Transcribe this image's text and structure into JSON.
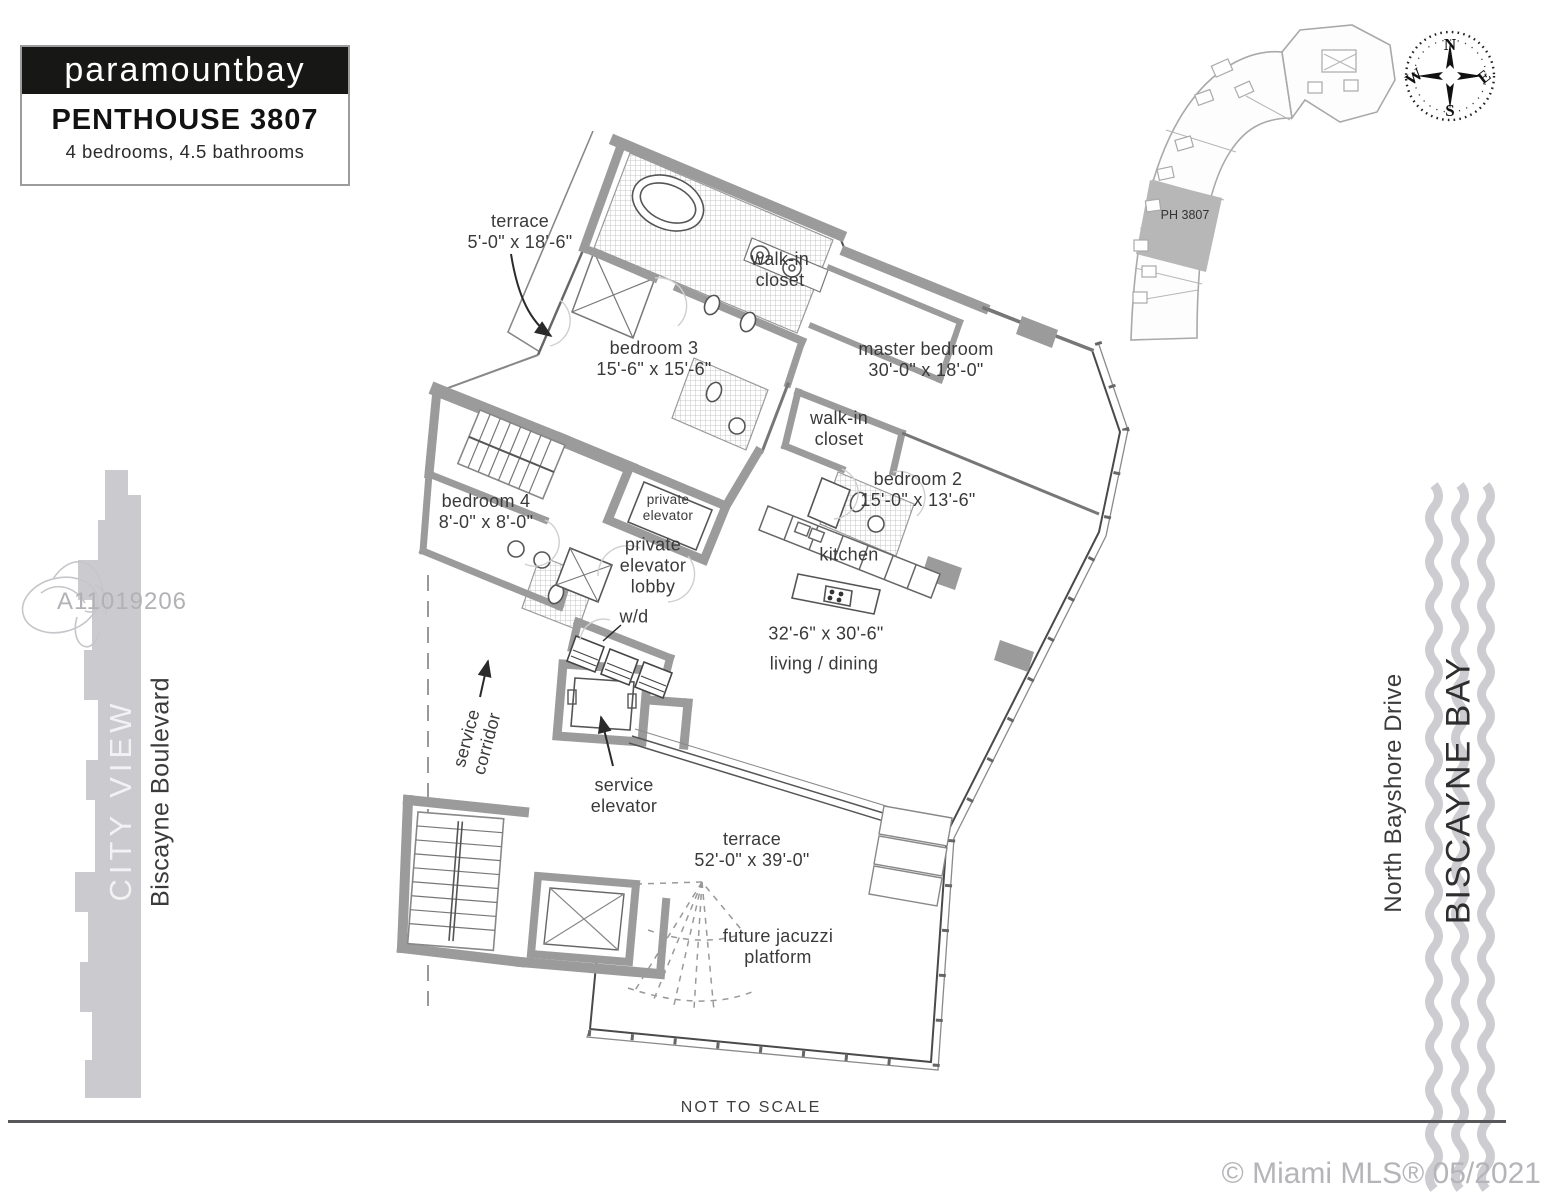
{
  "header": {
    "logo": "paramountbay",
    "title": "PENTHOUSE 3807",
    "subtitle": "4 bedrooms, 4.5 bathrooms"
  },
  "keyplan": {
    "unit_label": "PH 3807"
  },
  "compass": {
    "north": "N",
    "south": "S",
    "east": "E",
    "west": "W"
  },
  "surroundings": {
    "city_view": "CITY VIEW",
    "biscayne_boulevard": "Biscayne Boulevard",
    "north_bayshore_drive": "North Bayshore Drive",
    "biscayne_bay": "BISCAYNE BAY"
  },
  "watermark": {
    "mls_id": "A11019206"
  },
  "rooms": {
    "terrace_upper": "terrace\n5'-0\" x 18'-6\"",
    "walk_in_closet_top": "walk-in\ncloset",
    "bedroom3": "bedroom 3\n15'-6\" x 15'-6\"",
    "master_bedroom": "master bedroom\n30'-0\" x 18'-0\"",
    "walk_in_closet_master": "walk-in\ncloset",
    "bedroom2": "bedroom 2\n15'-0\" x 13'-6\"",
    "bedroom4": "bedroom 4\n8'-0\" x 8'-0\"",
    "private_elevator": "private\nelevator",
    "private_elevator_lobby": "private\nelevator\nlobby",
    "washer_dryer": "w/d",
    "kitchen": "kitchen",
    "living_dining_dims": "32'-6\" x 30'-6\"",
    "living_dining": "living / dining",
    "service_corridor": "service\ncorridor",
    "service_elevator": "service\nelevator",
    "terrace_main": "terrace\n52'-0\" x 39'-0\"",
    "future_jacuzzi": "future jacuzzi\nplatform"
  },
  "footer": {
    "scale_note": "NOT TO SCALE",
    "copyright": "© Miami MLS® 05/2021"
  },
  "colors": {
    "wall_gray": "#9b9b9b",
    "line_dark": "#4a4a4a",
    "accent_gray": "#cbcbcf",
    "watermark_gray": "#b2b2b6"
  }
}
